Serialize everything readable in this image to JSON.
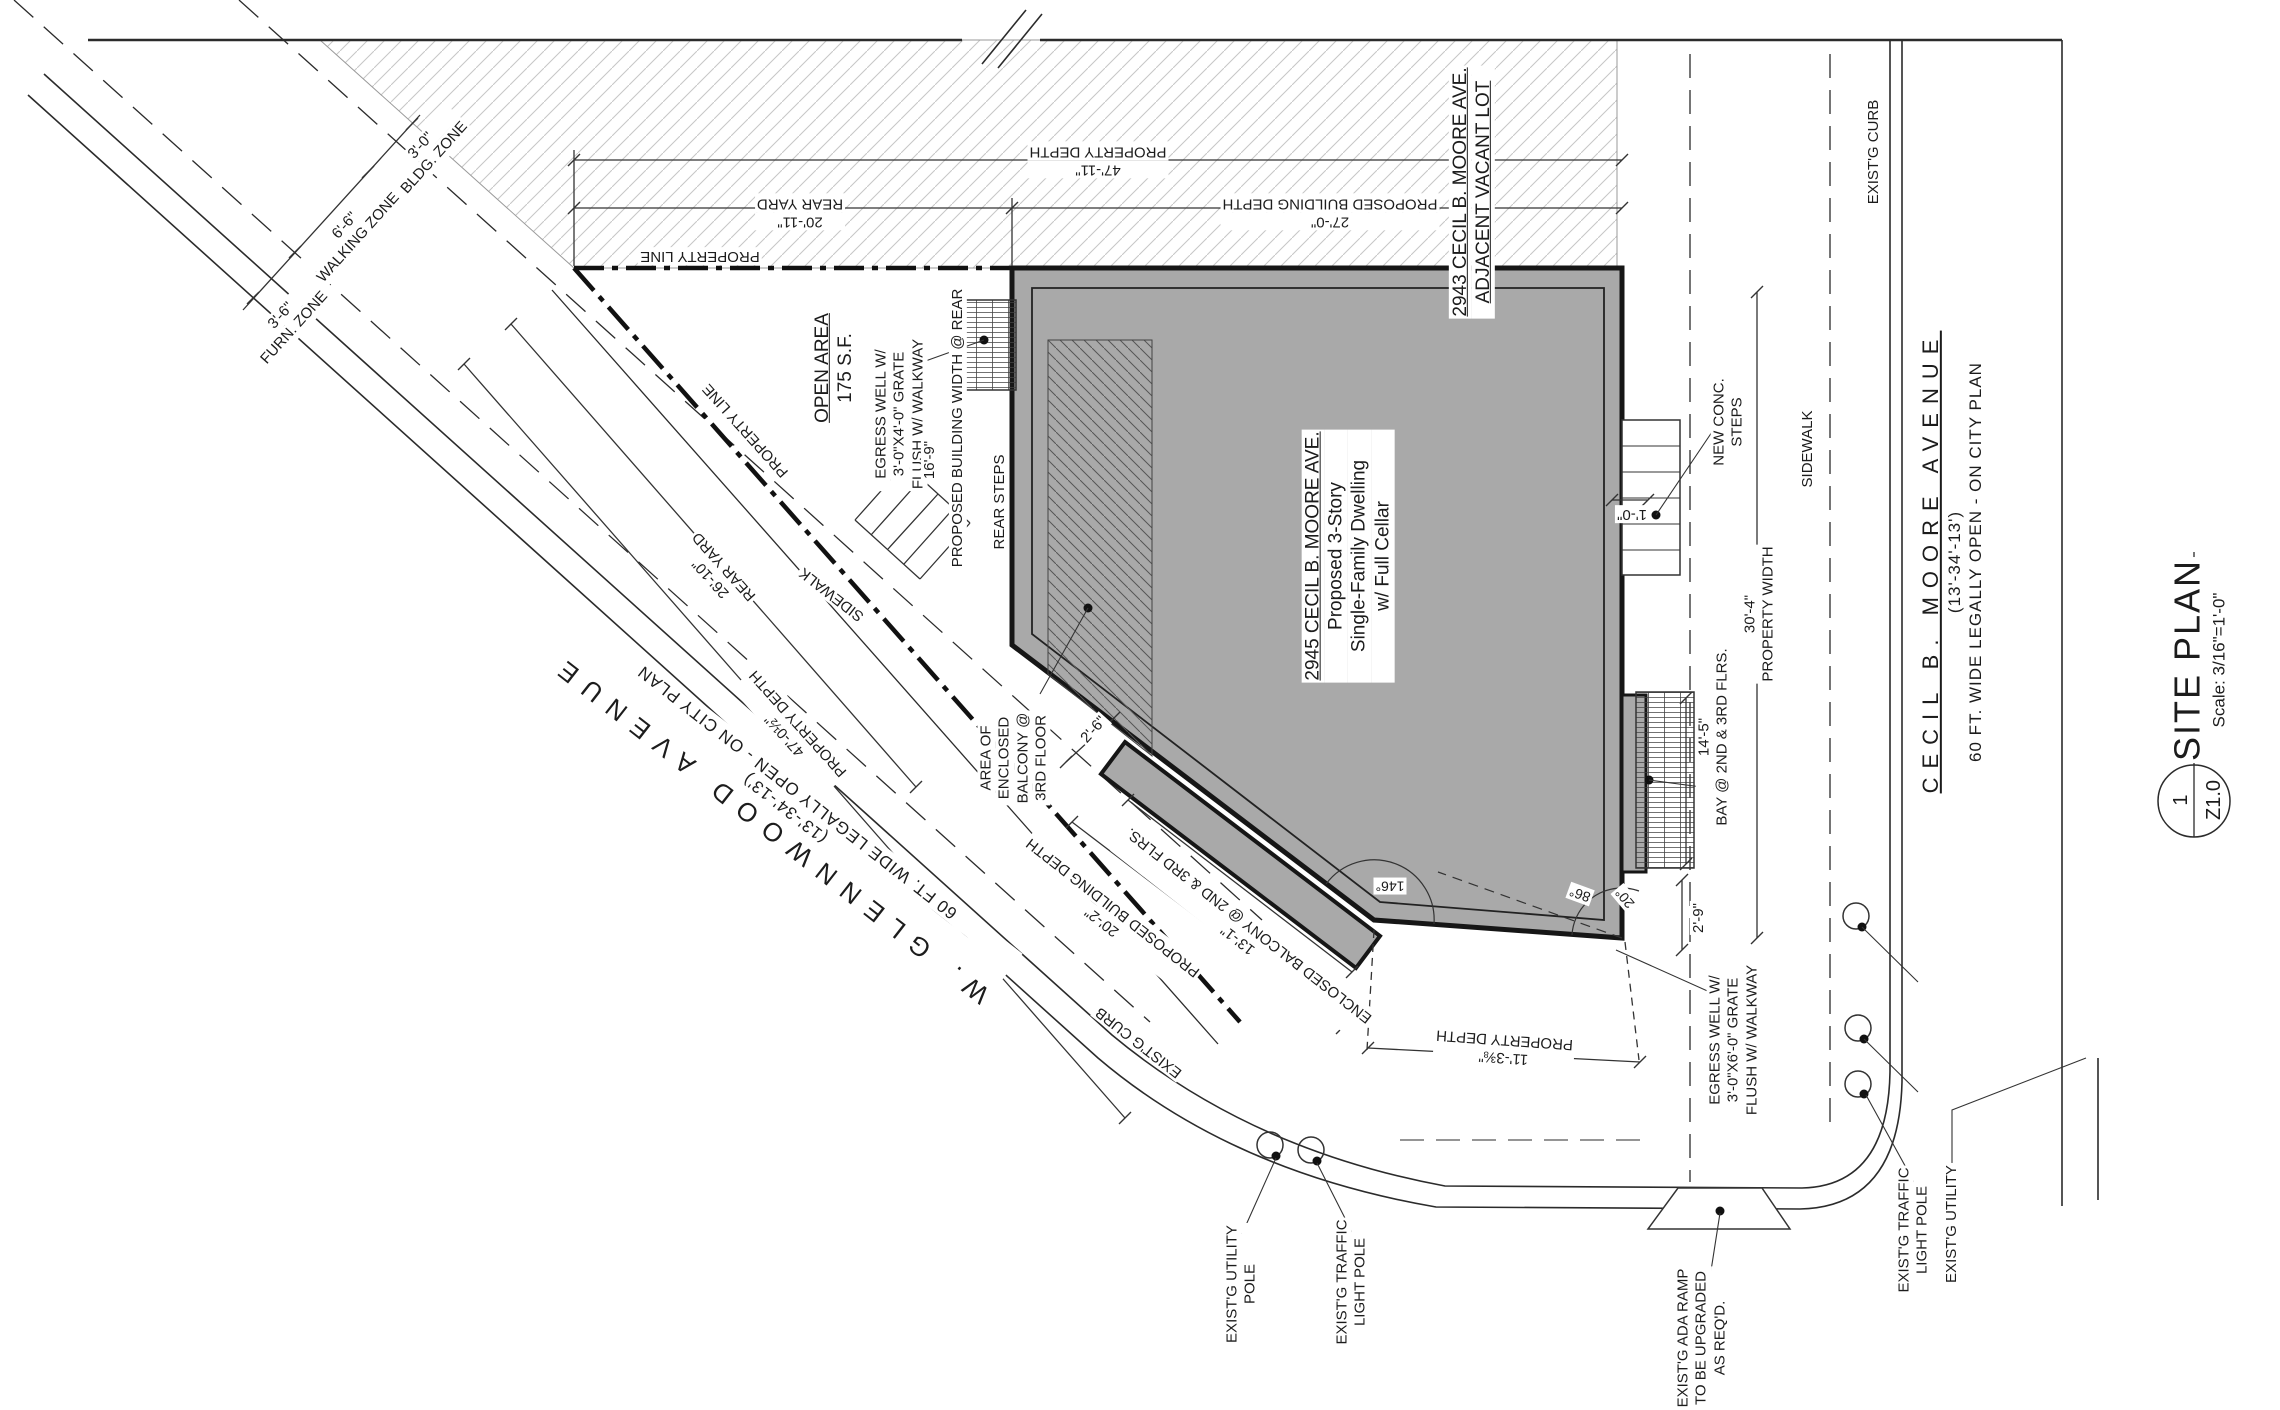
{
  "sheet": {
    "title": "SITE PLAN",
    "scale": "Scale: 3/16\"=1'-0\"",
    "detail_number": "1",
    "sheet_number": "Z1.0"
  },
  "streets": {
    "glennwood": {
      "name": "W. GLENNWOOD AVENUE",
      "width_note": "(13'-34'-13')",
      "legal_note": "60 FT. WIDE LEGALLY OPEN - ON CITY PLAN"
    },
    "cecil": {
      "name": "CECIL B. MOORE AVENUE",
      "width_note": "(13'-34'-13')",
      "legal_note": "60 FT. WIDE LEGALLY OPEN - ON CITY PLAN"
    }
  },
  "building": {
    "address": "2945 CECIL B. MOORE AVE.",
    "desc1": "Proposed 3-Story",
    "desc2": "Single-Family Dwelling",
    "desc3": "w/ Full Cellar"
  },
  "adjacent_lot": {
    "address": "2943 CECIL B. MOORE AVE.",
    "status": "ADJACENT VACANT LOT"
  },
  "open_area": {
    "title": "OPEN AREA",
    "area": "175 S.F."
  },
  "zones": {
    "furn": {
      "dim": "3'-6\"",
      "label": "FURN. ZONE"
    },
    "walking": {
      "dim": "6'-6\"",
      "label": "WALKING ZONE"
    },
    "bldg": {
      "dim": "3'-0\"",
      "label": "BLDG. ZONE"
    }
  },
  "dims": {
    "property_depth_top": {
      "label": "PROPERTY DEPTH",
      "value": "47'-11\""
    },
    "rear_yard_top": {
      "label": "REAR YARD",
      "value": "20'-11\""
    },
    "building_depth_top": {
      "label": "PROPOSED BUILDING DEPTH",
      "value": "27'-0\""
    },
    "property_depth_west": {
      "label": "PROPERTY DEPTH",
      "value": "47'-0½\""
    },
    "rear_yard_west": {
      "label": "REAR YARD",
      "value": "26'-10\""
    },
    "building_depth_sw": {
      "label": "PROPOSED BUILDING DEPTH",
      "value": "20'-2\""
    },
    "balcony_sw": {
      "label": "ENCLOSED BALCONY @ 2ND & 3RD FLRS.",
      "value": "13'-1\""
    },
    "property_depth_south": {
      "label": "PROPERTY DEPTH",
      "value": "11'-3⅜\""
    },
    "property_width": {
      "label": "PROPERTY WIDTH",
      "value": "30'-4\""
    },
    "bay": {
      "label": "BAY @ 2ND & 3RD FLRS.",
      "value": "14'-5\""
    },
    "building_width_rear": {
      "label": "PROPOSED BUILDING WIDTH @ REAR",
      "value": "16'-9\""
    },
    "balcony_offset": "2'-6\"",
    "bay_offset": "2'-9\"",
    "steps_offset": "1'-0\"",
    "angle_sw": "146°",
    "angle_se": "86°",
    "angle_se2": "20°"
  },
  "labels": {
    "property_line": "PROPERTY LINE",
    "sidewalk": "SIDEWALK",
    "exist_curb": "EXIST'G CURB",
    "rear_steps": "REAR STEPS",
    "new_conc": [
      "NEW CONC.",
      "STEPS"
    ],
    "egress_rear": [
      "EGRESS WELL W/",
      "3'-0\"X4'-0\" GRATE",
      "FLUSH W/ WALKWAY"
    ],
    "egress_front": [
      "EGRESS WELL W/",
      "3'-0\"X6'-0\" GRATE",
      "FLUSH W/ WALKWAY"
    ],
    "balcony_area": [
      "AREA OF",
      "ENCLOSED",
      "BALCONY @",
      "3RD FLOOR"
    ],
    "utility_pole": [
      "EXIST'G UTILITY",
      "POLE"
    ],
    "traffic_pole": [
      "EXIST'G TRAFFIC",
      "LIGHT POLE"
    ],
    "ada_ramp": [
      "EXIST'G ADA RAMP",
      "TO BE UPGRADED",
      "AS REQ'D."
    ],
    "exist_utility": "EXIST'G UTILITY"
  },
  "colors": {
    "building_fill": "#a9a9a9",
    "line": "#2b2b2b",
    "hatch": "#c6c6c6"
  }
}
